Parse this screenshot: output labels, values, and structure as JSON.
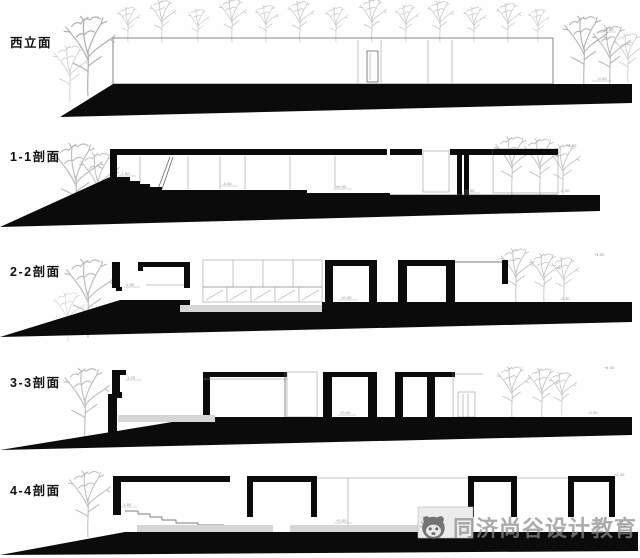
{
  "sheet": {
    "background": "#fefefe"
  },
  "colors": {
    "ink": "#0b0b0b",
    "tree": "#b2b2b2",
    "platform_slab": "#d6d6d6",
    "thin_outline": "#8a8a8a",
    "annotation": "#8a8a8a",
    "watermark": "#8a8a8a"
  },
  "panels": [
    {
      "id": "west-elevation",
      "label": "西立面",
      "annotations": [
        {
          "text": "+4.00"
        },
        {
          "text": "-0.30"
        }
      ]
    },
    {
      "id": "section-1-1",
      "label": "1-1剖面",
      "annotations": [
        {
          "text": "-1.50"
        },
        {
          "text": "-3.40"
        },
        {
          "text": "±0.00"
        },
        {
          "text": "+0.00"
        },
        {
          "text": "+4.00"
        },
        {
          "text": "-0.30"
        }
      ]
    },
    {
      "id": "section-2-2",
      "label": "2-2剖面",
      "annotations": [
        {
          "text": "1.00"
        },
        {
          "text": "+0.00"
        },
        {
          "text": "+4.00"
        },
        {
          "text": "-0.30"
        }
      ]
    },
    {
      "id": "section-3-3",
      "label": "3-3剖面",
      "annotations": [
        {
          "text": "1.20"
        },
        {
          "text": "+0.00"
        },
        {
          "text": "+4.00"
        },
        {
          "text": "-0.30"
        }
      ]
    },
    {
      "id": "section-4-4",
      "label": "4-4剖面",
      "annotations": [
        {
          "text": "1.50"
        },
        {
          "text": "+0.00"
        },
        {
          "text": "+4.00"
        },
        {
          "text": "-0.30"
        }
      ]
    }
  ],
  "watermark": {
    "text": "同济尚谷设计教育",
    "icon": "panda-logo"
  }
}
